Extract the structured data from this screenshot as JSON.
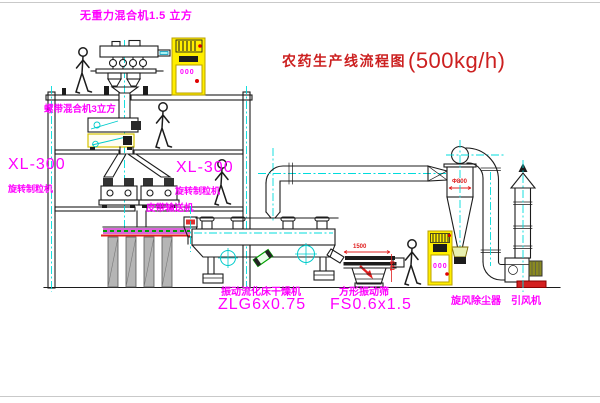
{
  "title": {
    "text": "农药生产线流程图",
    "capacity": "(500kg/h)"
  },
  "labels": {
    "gravity_free_mixer": "无重力混合机1.5 立方",
    "ribbon_mixer": "螺带混合机3立方",
    "granulator_left": {
      "model": "XL-300",
      "name": "旋转制粒机"
    },
    "granulator_center": {
      "model": "XL-300",
      "name": "旋转制粒机"
    },
    "belt_conveyor": "皮带输送机",
    "dryer": {
      "name": "振动流化床干燥机",
      "model": "ZLG6x0.75"
    },
    "screen": {
      "name": "方形振动筛",
      "model": "FS0.6x1.5"
    },
    "cyclone": "旋风除尘器",
    "fan": "引风机"
  },
  "dimensions": {
    "screen_length": "1500",
    "screen_height": "541",
    "cyclone_diameter": "Φ800"
  },
  "cabinets": {
    "top_display": "000",
    "ground_display": "000"
  },
  "colors": {
    "label": "#ff00ff",
    "title": "#cc2020",
    "dimension": "#e02020",
    "centerline": "#00dcdc",
    "cabinet": "#ffee00",
    "line": "#1c1c1c"
  }
}
